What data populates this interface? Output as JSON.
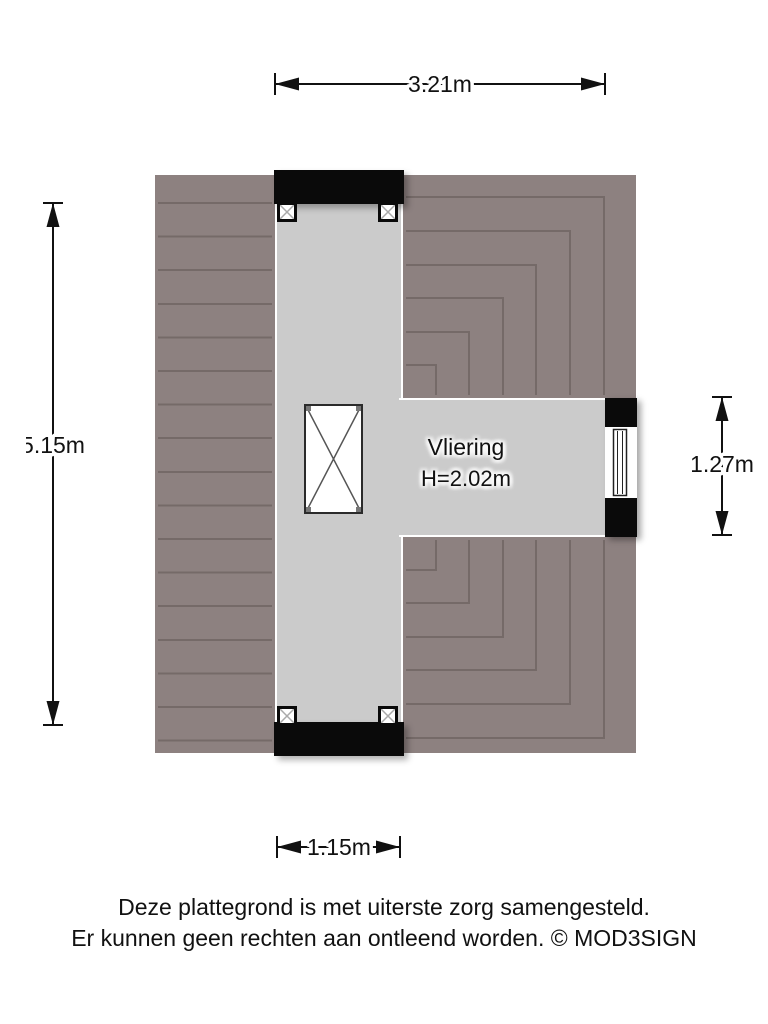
{
  "labels": {
    "room_name": "Vliering",
    "room_height": "H=2.02m"
  },
  "dimensions": {
    "top": "3.21m",
    "left": "5.15m",
    "right": "1.27m",
    "bottom": "1.15m"
  },
  "footer": {
    "line1": "Deze plattegrond is met uiterste zorg samengesteld.",
    "line2": "Er kunnen geen rechten aan ontleend worden. © MOD3SIGN"
  },
  "colors": {
    "roof": "#8D8180",
    "roof_line": "#756A68",
    "floor": "#CBCBCB",
    "wall": "#0A0A0A",
    "background": "#FFFFFF"
  },
  "symbols": {
    "stair_opening": "crossed-box-opening-icon",
    "post_marker": "x-post-marker-icon",
    "window": "window-glazing-icon"
  }
}
